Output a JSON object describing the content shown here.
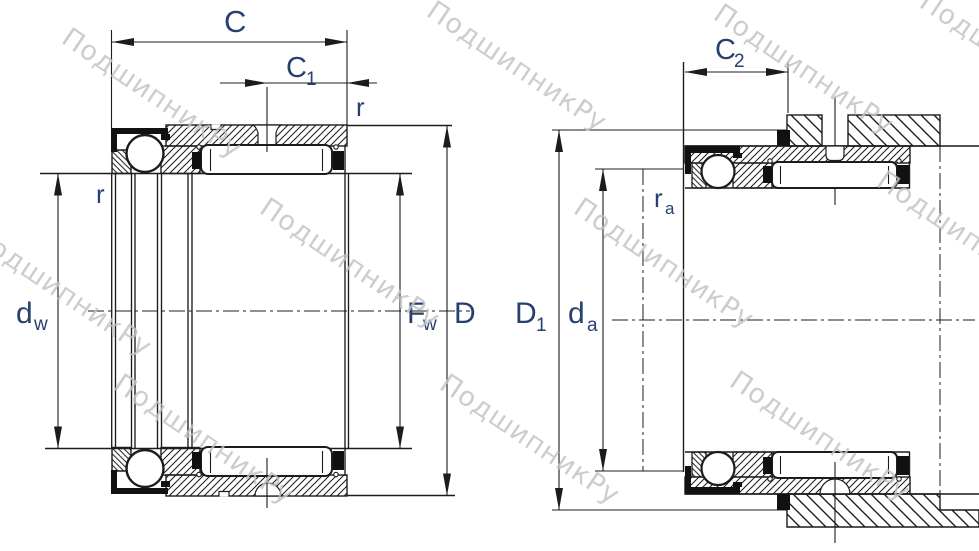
{
  "drawing": {
    "kind": "bearing-cross-section-technical-drawing",
    "views": {
      "left": {
        "name": "bearing dimensions view",
        "labels": {
          "C": {
            "main": "C"
          },
          "C1": {
            "main": "C",
            "sub": "1"
          },
          "r_top": {
            "main": "r"
          },
          "r_left": {
            "main": "r"
          },
          "dw": {
            "main": "d",
            "sub": "w"
          },
          "Fw": {
            "main": "F",
            "sub": "w"
          },
          "D": {
            "main": "D"
          }
        }
      },
      "right": {
        "name": "mounting dimensions view",
        "labels": {
          "C2": {
            "main": "C",
            "sub": "2"
          },
          "ra": {
            "main": "r",
            "sub": "a"
          },
          "D1": {
            "main": "D",
            "sub": "1"
          },
          "da": {
            "main": "d",
            "sub": "a"
          }
        }
      }
    }
  },
  "watermark": {
    "text": "ПодшипникРу",
    "color": "#c2c2c2"
  },
  "colors": {
    "line": "#1c1c1c",
    "label": "#26406f",
    "background": "#ffffff"
  }
}
